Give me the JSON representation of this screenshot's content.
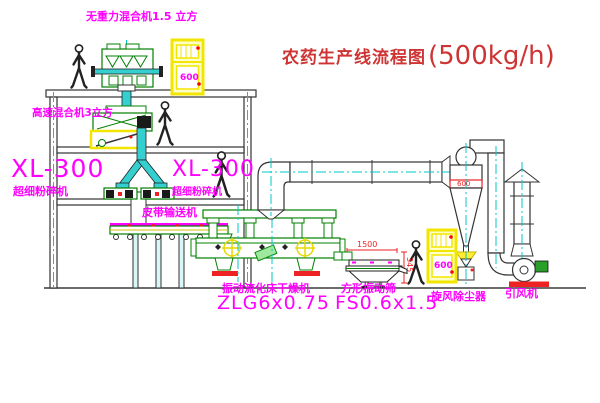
{
  "title": {
    "text": "农药生产线流程图",
    "capacity": "(500kg/h)"
  },
  "labels": {
    "top_mixer": "无重力混合机1.5 立方",
    "highspeed_mixer": "高速混合机3立方",
    "pulverizer_left_model": "XL-300",
    "pulverizer_left_name": "超细粉碎机",
    "pulverizer_right_model": "XL-300",
    "pulverizer_right_name": "超细粉碎机",
    "belt_conveyor": "皮带输送机",
    "dryer_name": "振动流化床干燥机",
    "dryer_model": "ZLG6x0.75",
    "sieve_name": "方形振动筛",
    "sieve_model": "FS0.6x1.5",
    "cyclone": "旋风除尘器",
    "fan": "引风机"
  },
  "dimensions": {
    "sieve_length": "1500",
    "sieve_height": "345",
    "cyclone_diameter": "600",
    "cabinet_top_mark": "600",
    "cabinet_ground_mark": "600"
  },
  "colors": {
    "equipment_green": "#008000",
    "centerline_cyan": "#00c8c8",
    "pipe_cyan": "#35cfcf",
    "label_magenta": "#ff00ff",
    "title_red": "#cf3434",
    "dimension_red": "#ee2222",
    "cabinet_yellow": "#f2e600",
    "base_red": "#ee2222",
    "motor_green": "#2aa02a"
  }
}
